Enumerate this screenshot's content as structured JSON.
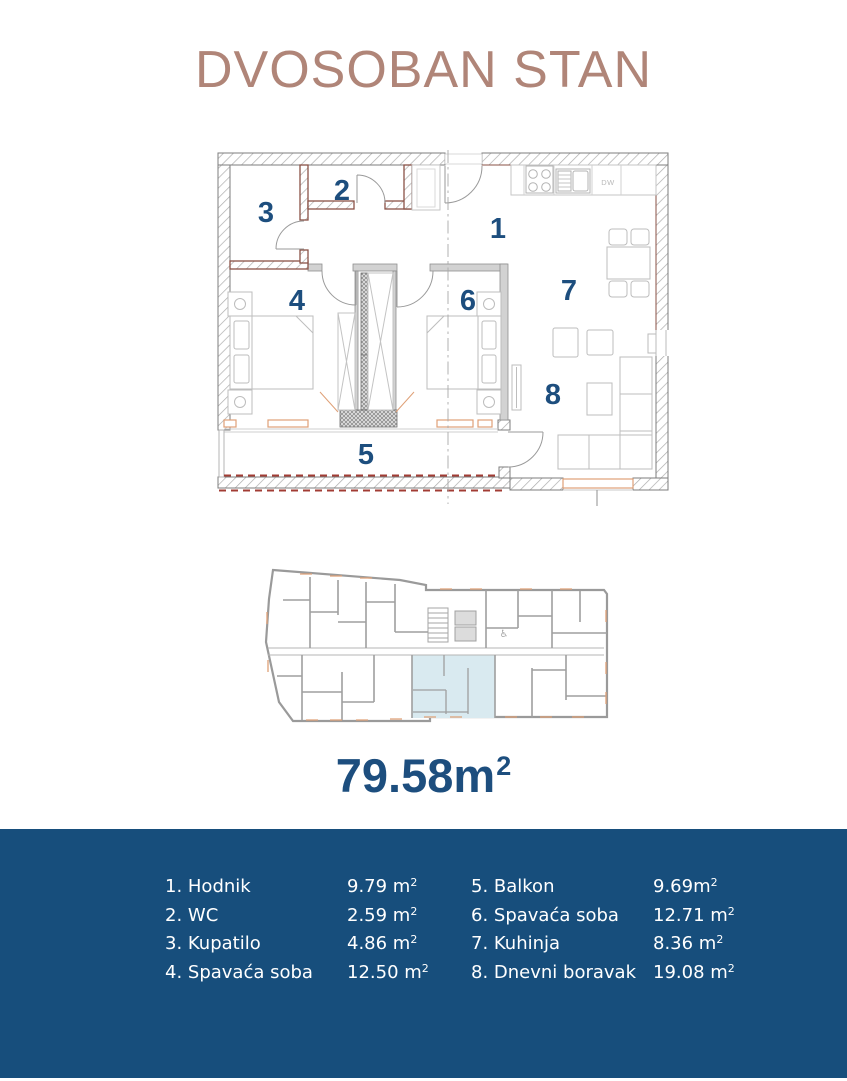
{
  "title": "DVOSOBAN STAN",
  "area": {
    "value": "79.58m",
    "sup": "2"
  },
  "plan": {
    "room_numbers": [
      "1",
      "2",
      "3",
      "4",
      "5",
      "6",
      "7",
      "8"
    ],
    "dw_label": "DW"
  },
  "legend": {
    "rooms": [
      {
        "label": "1. Hodnik",
        "value": "9.79 m",
        "sup": "2"
      },
      {
        "label": "2. WC",
        "value": "2.59 m",
        "sup": "2"
      },
      {
        "label": "3. Kupatilo",
        "value": "4.86 m",
        "sup": "2"
      },
      {
        "label": "4. Spavaća soba",
        "value": "12.50 m",
        "sup": "2"
      },
      {
        "label": "5. Balkon",
        "value": "9.69m",
        "sup": "2"
      },
      {
        "label": "6. Spavaća soba",
        "value": "12.71 m",
        "sup": "2"
      },
      {
        "label": "7. Kuhinja",
        "value": "8.36 m",
        "sup": "2"
      },
      {
        "label": "8. Dnevni boravak",
        "value": "19.08 m",
        "sup": "2"
      }
    ]
  },
  "colors": {
    "accent_blue": "#1d4e7e",
    "footer_bg": "#174e7c",
    "title_brown": "#b08578",
    "highlight_blue": "#d9eaf0",
    "window_orange": "#dfa077",
    "balcony_red": "#a23c34"
  }
}
